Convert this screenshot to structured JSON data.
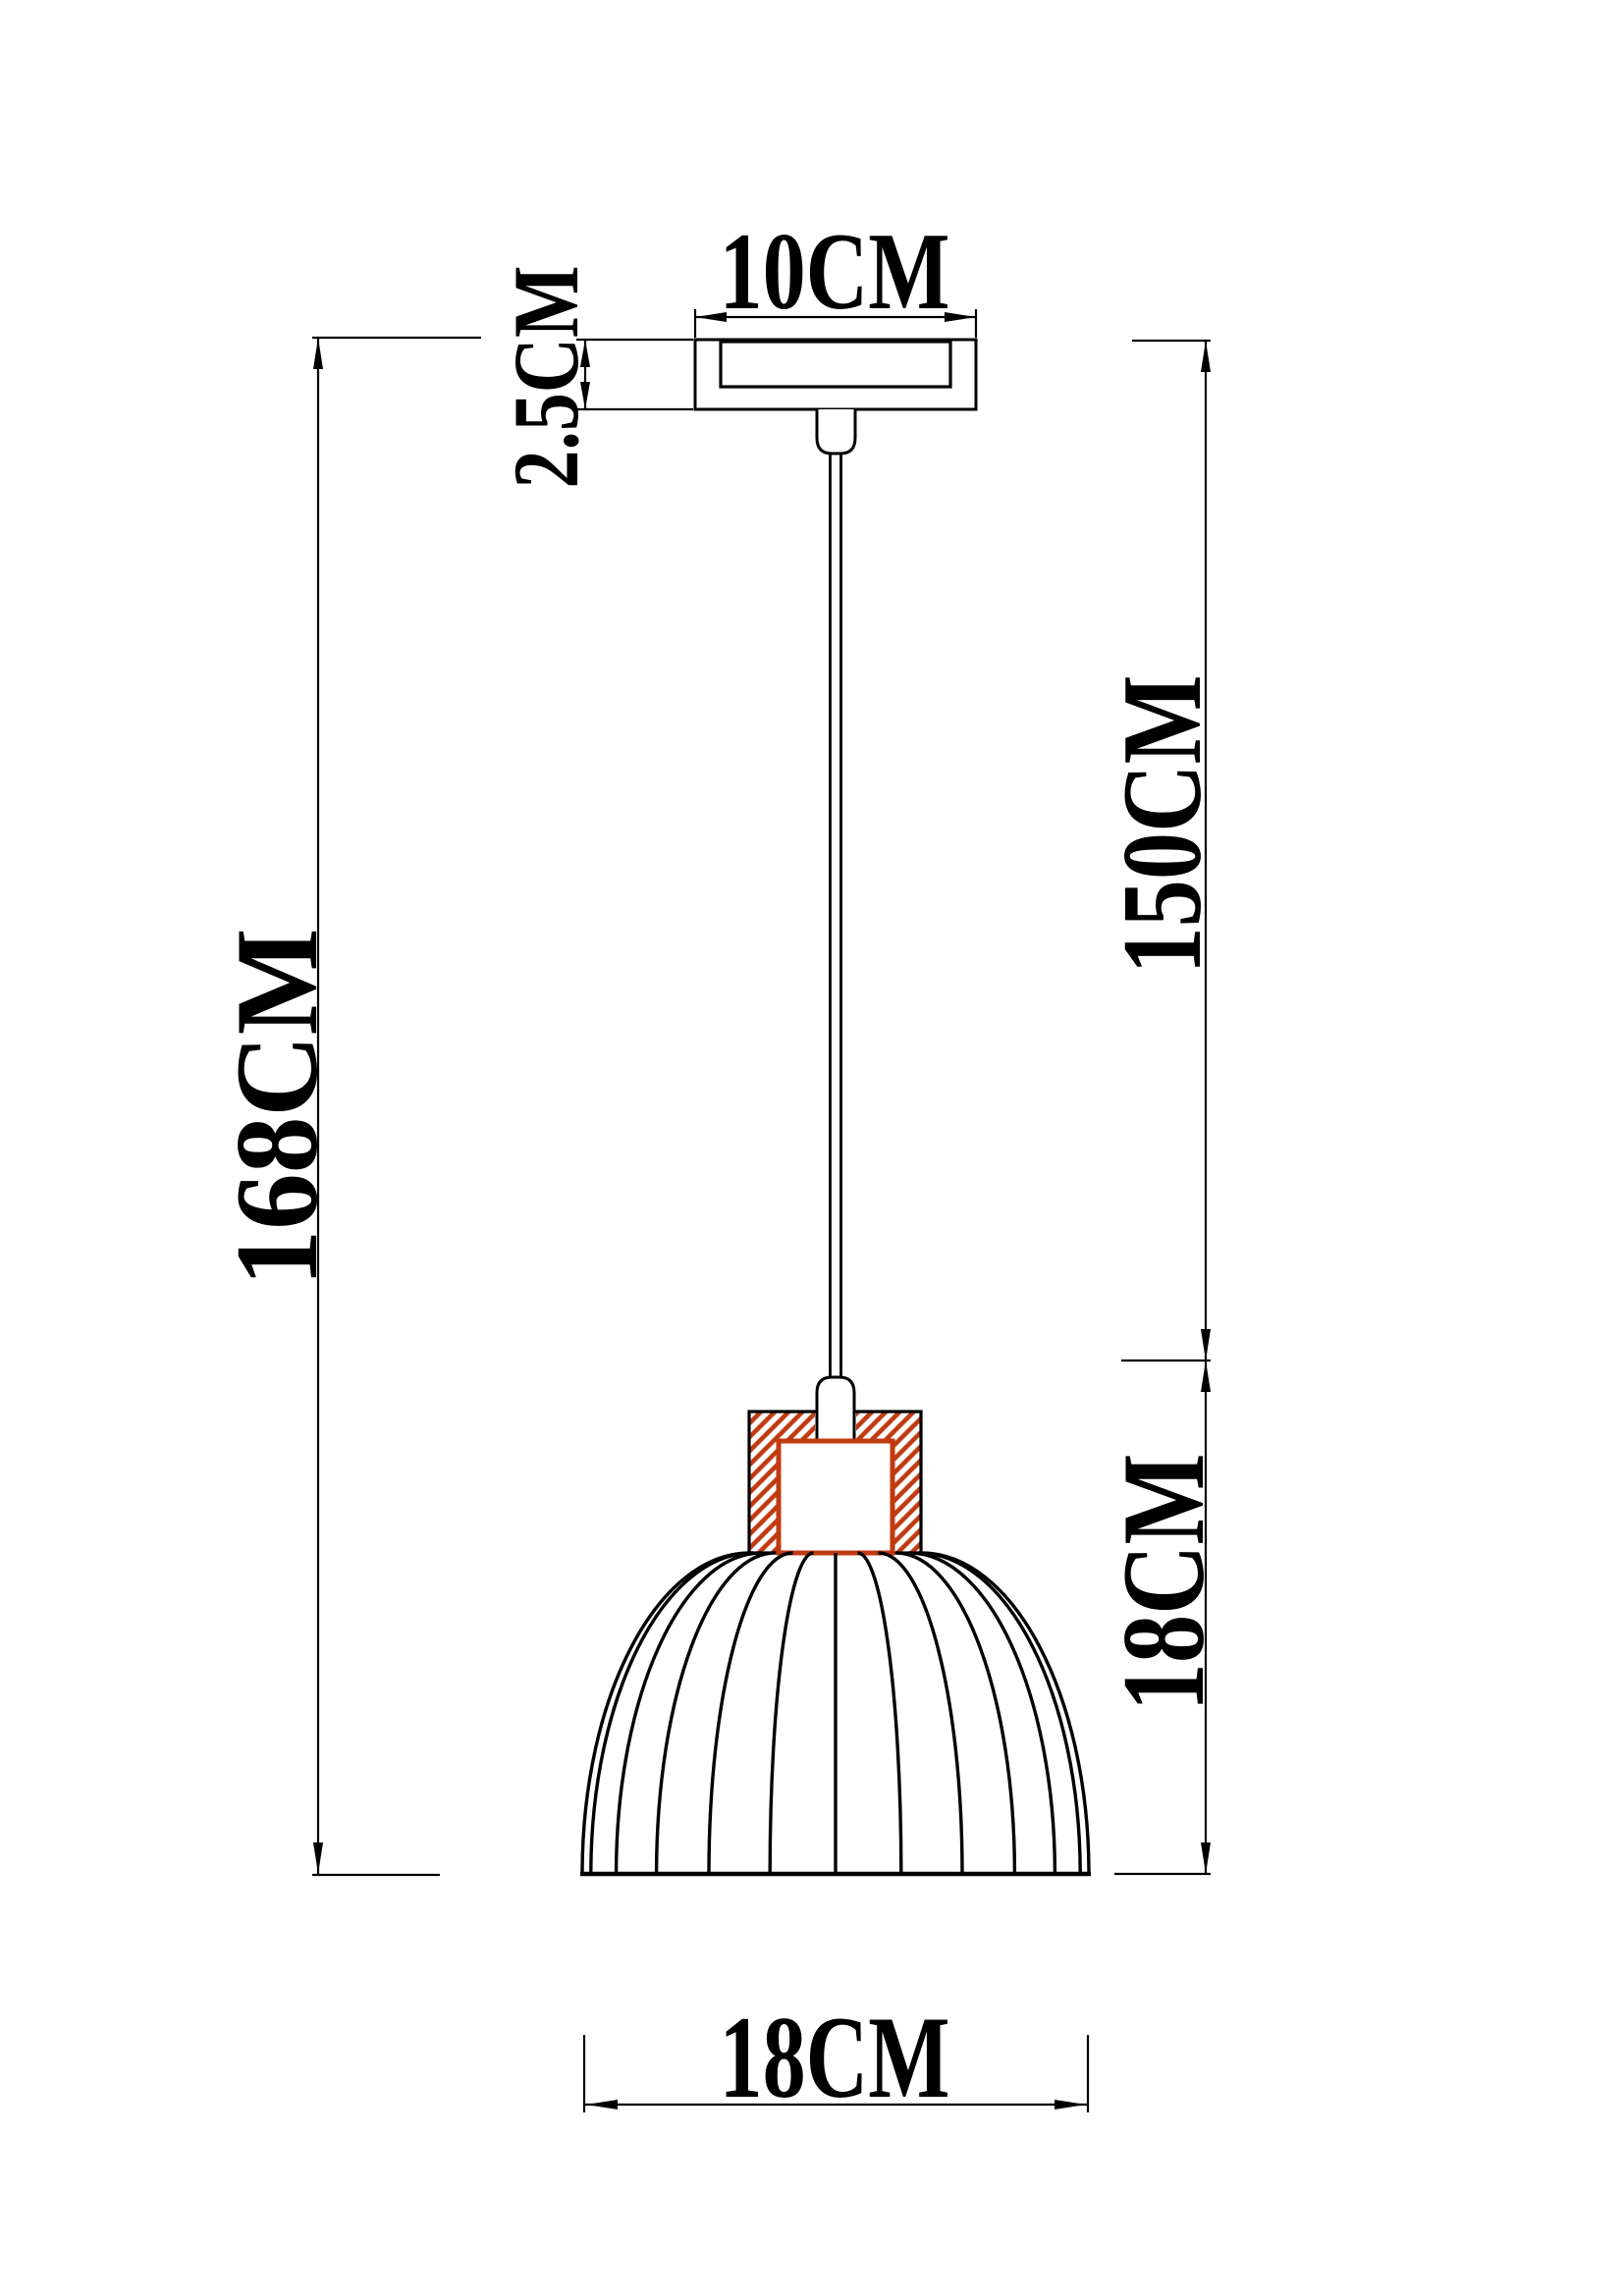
{
  "drawing": {
    "type": "pendant lamp dimensional diagram",
    "labels": {
      "canopy_width": "10CM",
      "canopy_height": "2.5CM",
      "cord_drop": "150CM",
      "total_height": "168CM",
      "shade_height": "18CM",
      "shade_width": "18CM"
    },
    "colors": {
      "line": "#000000",
      "accent": "#c03a10",
      "background": "#ffffff"
    }
  }
}
